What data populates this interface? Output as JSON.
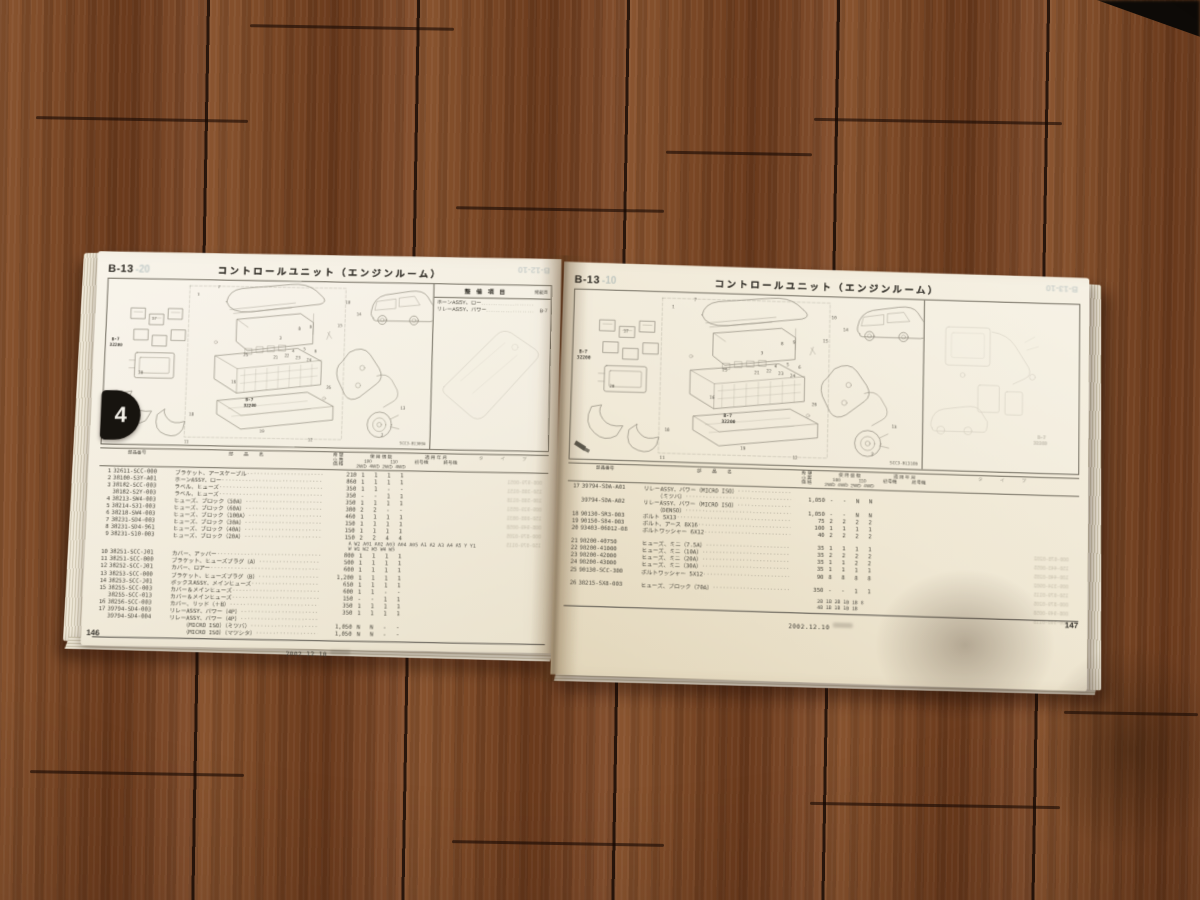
{
  "photo": {
    "floor_base": "#7b4826",
    "floor_seam": "#2f1708",
    "page_color": "#f3eee1",
    "ink_color": "#45423a",
    "tab_color": "#17140f",
    "print_line_color": "#8f8a7c"
  },
  "tabs": {
    "left_label": "4",
    "right_label": "4"
  },
  "table_headers": {
    "part_no": "部品番号",
    "part_name": "部　品　名",
    "price_l1": "希 望",
    "price_l2": "小 売",
    "price_l3": "価 格",
    "qty": "使 用 個 数",
    "group_100": "100",
    "group_110": "110",
    "drive_2wd": "2WD",
    "drive_4wd": "4WD",
    "applicable": "適 用 年 月",
    "serial_start": "初号機",
    "serial_end": "終号機",
    "type": "タ イ プ"
  },
  "left_page": {
    "section_code": "B-13",
    "section_ghost": "-20",
    "corner_ghost": "B-12-10",
    "title": "コントロールユニット（エンジンルーム）",
    "page_number": "146",
    "footer_date": "2002.12.10",
    "diagram": {
      "ref_label_1": "B-7",
      "ref_num_1": "32200",
      "ref_label_2": "B-7",
      "ref_num_2": "32200",
      "code": "SCC3-B1300A",
      "callouts": [
        "1",
        "2",
        "3",
        "4",
        "5",
        "6",
        "7",
        "8",
        "9",
        "10",
        "11",
        "12",
        "13",
        "14",
        "15",
        "16",
        "17",
        "18",
        "19",
        "20",
        "21",
        "22",
        "23",
        "24",
        "25",
        "26"
      ]
    },
    "service_panel": {
      "header": "整 備 項 目",
      "header_right": "掲載頁",
      "rows": [
        {
          "label": "ホーンASSY、ロー",
          "ref": ""
        },
        {
          "label": "リレーASSY、パワー",
          "ref": "B-7"
        }
      ]
    },
    "rows": [
      {
        "i": "1",
        "pn": "32611-SCC-000",
        "n": "ブラケット、アースケーブル",
        "p": "210",
        "q": [
          "1",
          "1",
          "1",
          "1"
        ]
      },
      {
        "i": "2",
        "pn": "38100-S3Y-A01",
        "n": "ホーンASSY、ロー",
        "p": "860",
        "q": [
          "1",
          "1",
          "1",
          "1"
        ]
      },
      {
        "i": "3",
        "pn": "38182-SCC-003",
        "n": "ラベル、ヒューズ",
        "p": "350",
        "q": [
          "1",
          "1",
          "-",
          "-"
        ]
      },
      {
        "i": "",
        "pn": "38182-S2Y-003",
        "n": "ラベル、ヒューズ",
        "p": "350",
        "q": [
          "-",
          "-",
          "1",
          "1"
        ]
      },
      {
        "i": "4",
        "pn": "38213-SW4-003",
        "n": "ヒューズ、ブロック（50A）",
        "p": "350",
        "q": [
          "1",
          "1",
          "1",
          "1"
        ]
      },
      {
        "i": "5",
        "pn": "38214-S31-003",
        "n": "ヒューズ、ブロック（60A）",
        "p": "380",
        "q": [
          "2",
          "2",
          "-",
          "-"
        ]
      },
      {
        "i": "6",
        "pn": "38218-SW4-003",
        "n": "ヒューズ、ブロック（100A）",
        "p": "460",
        "q": [
          "1",
          "1",
          "1",
          "1"
        ]
      },
      {
        "i": "7",
        "pn": "38231-SD4-003",
        "n": "ヒューズ、ブロック（30A）",
        "p": "150",
        "q": [
          "1",
          "1",
          "1",
          "1"
        ]
      },
      {
        "i": "8",
        "pn": "38231-SD4-961",
        "n": "ヒューズ、ブロック（40A）",
        "p": "150",
        "q": [
          "1",
          "1",
          "1",
          "1"
        ]
      },
      {
        "i": "9",
        "pn": "38231-S10-003",
        "n": "ヒューズ、ブロック（20A）",
        "p": "150",
        "q": [
          "2",
          "2",
          "4",
          "4"
        ]
      },
      {
        "ann": "A W2 A01 A02 A03 A04 A05 A1 A2 A3 A4 A5 Y Y1"
      },
      {
        "ann": "W W1 W2 W3 W4 W5"
      },
      {
        "i": "10",
        "pn": "38251-SCC-J01",
        "n": "カバー、アッパー",
        "p": "800",
        "q": [
          "1",
          "1",
          "1",
          "1"
        ]
      },
      {
        "i": "11",
        "pn": "38251-SCC-000",
        "n": "ブラケット、ヒューズプラグ（A）",
        "p": "500",
        "q": [
          "1",
          "1",
          "1",
          "1"
        ]
      },
      {
        "i": "12",
        "pn": "38252-SCC-J01",
        "n": "カバー、ロアー",
        "p": "600",
        "q": [
          "1",
          "1",
          "1",
          "1"
        ]
      },
      {
        "i": "13",
        "pn": "38253-SCC-000",
        "n": "ブラケット、ヒューズプラグ（B）",
        "p": "1,200",
        "q": [
          "1",
          "1",
          "1",
          "1"
        ]
      },
      {
        "i": "14",
        "pn": "38253-SCC-J01",
        "n": "ボックスASSY、メインヒューズ",
        "p": "650",
        "q": [
          "1",
          "1",
          "1",
          "1"
        ]
      },
      {
        "i": "15",
        "pn": "38255-SCC-003",
        "n": "カバー＆メインヒューズ",
        "p": "600",
        "q": [
          "1",
          "1",
          "-",
          "-"
        ]
      },
      {
        "i": "",
        "pn": "38255-SCC-013",
        "n": "カバー＆メインヒューズ",
        "p": "150",
        "q": [
          "-",
          "-",
          "1",
          "1"
        ]
      },
      {
        "i": "16",
        "pn": "38256-SCC-003",
        "n": "カバー、リッド（＋B）",
        "p": "350",
        "q": [
          "1",
          "1",
          "1",
          "1"
        ]
      },
      {
        "i": "17",
        "pn": "39794-SD4-003",
        "n": "リレーASSY、パワー（4P）",
        "p": "350",
        "q": [
          "1",
          "1",
          "1",
          "1"
        ]
      },
      {
        "i": "",
        "pn": "39794-SD4-004",
        "n": "リレーASSY、パワー（4P）",
        "p": "",
        "q": [
          "",
          "",
          "",
          ""
        ]
      },
      {
        "i": "",
        "pn": "",
        "ind": true,
        "n": "（MICRO ISO）（ミツバ）",
        "p": "1,050",
        "q": [
          "N",
          "N",
          "-",
          "-"
        ]
      },
      {
        "i": "",
        "pn": "",
        "ind": true,
        "n": "（MICRO ISO）（マツシタ）",
        "p": "1,050",
        "q": [
          "N",
          "N",
          "-",
          "-"
        ]
      }
    ],
    "ghost_lines": [
      "008-979-0051",
      "150-308-0151",
      "100-508-0118",
      "009-919-0551",
      "150-008-0831",
      "008-949-0058",
      "000-879-0205",
      "150-079-0115"
    ]
  },
  "right_page": {
    "section_code": "B-13",
    "section_ghost": "-10",
    "corner_ghost": "B-13-10",
    "title": "コントロールユニット（エンジンルーム）",
    "page_number": "147",
    "footer_date": "2002.12.10",
    "diagram": {
      "ref_label_1": "B-7",
      "ref_num_1": "32200",
      "ref_label_2": "B-7",
      "ref_num_2": "32200",
      "code": "SCC3-B1310B",
      "callouts": [
        "1",
        "2",
        "3",
        "4",
        "5",
        "6",
        "7",
        "8",
        "9",
        "10",
        "11",
        "12",
        "13",
        "14",
        "15",
        "16",
        "17",
        "18",
        "19",
        "20",
        "21",
        "22",
        "23",
        "24",
        "25",
        "26"
      ]
    },
    "side_panel": {
      "ref_label": "B-7",
      "ref_num": "32200"
    },
    "rows": [
      {
        "i": "17",
        "pn": "39794-SDA-A01",
        "n": "リレーASSY、パワー（MICRO ISO）",
        "p": "",
        "q": [
          "",
          "",
          "",
          ""
        ]
      },
      {
        "i": "",
        "pn": "",
        "ind": true,
        "n": "（ミツバ）",
        "p": "1,050",
        "q": [
          "-",
          "-",
          "N",
          "N"
        ]
      },
      {
        "i": "",
        "pn": "39794-SDA-A02",
        "n": "リレーASSY、パワー（MICRO ISO）",
        "p": "",
        "q": [
          "",
          "",
          "",
          ""
        ]
      },
      {
        "i": "",
        "pn": "",
        "ind": true,
        "n": "（DENSO）",
        "p": "1,050",
        "q": [
          "-",
          "-",
          "N",
          "N"
        ]
      },
      {
        "i": "18",
        "pn": "90130-SR3-003",
        "n": "ボルト 5X13",
        "p": "75",
        "q": [
          "2",
          "2",
          "2",
          "2"
        ]
      },
      {
        "i": "19",
        "pn": "90150-S84-003",
        "n": "ボルト、アース 8X16",
        "p": "100",
        "q": [
          "1",
          "1",
          "1",
          "1"
        ]
      },
      {
        "i": "20",
        "pn": "93403-06012-08",
        "n": "ボルトワッシャー 6X12",
        "p": "40",
        "q": [
          "2",
          "2",
          "2",
          "2"
        ]
      },
      {
        "blank": true
      },
      {
        "i": "21",
        "pn": "98200-40750",
        "n": "ヒューズ、ミニ（7.5A）",
        "p": "35",
        "q": [
          "1",
          "1",
          "1",
          "1"
        ]
      },
      {
        "i": "22",
        "pn": "98200-41000",
        "n": "ヒューズ、ミニ（10A）",
        "p": "35",
        "q": [
          "2",
          "2",
          "2",
          "2"
        ]
      },
      {
        "i": "23",
        "pn": "98200-42000",
        "n": "ヒューズ、ミニ（20A）",
        "p": "35",
        "q": [
          "1",
          "1",
          "2",
          "2"
        ]
      },
      {
        "i": "24",
        "pn": "98200-43000",
        "n": "ヒューズ、ミニ（30A）",
        "p": "35",
        "q": [
          "1",
          "1",
          "1",
          "1"
        ]
      },
      {
        "i": "25",
        "pn": "90130-SCC-300",
        "n": "ボルトワッシャー 5X12",
        "p": "90",
        "q": [
          "8",
          "8",
          "8",
          "8"
        ]
      },
      {
        "blank": true
      },
      {
        "i": "26",
        "pn": "38215-SX8-003",
        "n": "ヒューズ、ブロック（70A）",
        "p": "350",
        "q": [
          "-",
          "-",
          "1",
          "1"
        ]
      },
      {
        "blank": true
      },
      {
        "ann": "2B 1B 2B 1B 1B 8"
      },
      {
        "ann": "4B 1B 1B 1B 1B"
      }
    ],
    "ghost_lines": [
      "000-678-0202",
      "150-443-0055",
      "100-440-0285",
      "009-314-0902",
      "150-079-0115",
      "000-879-0205",
      "008-949-0058",
      "100-508-0118"
    ]
  }
}
